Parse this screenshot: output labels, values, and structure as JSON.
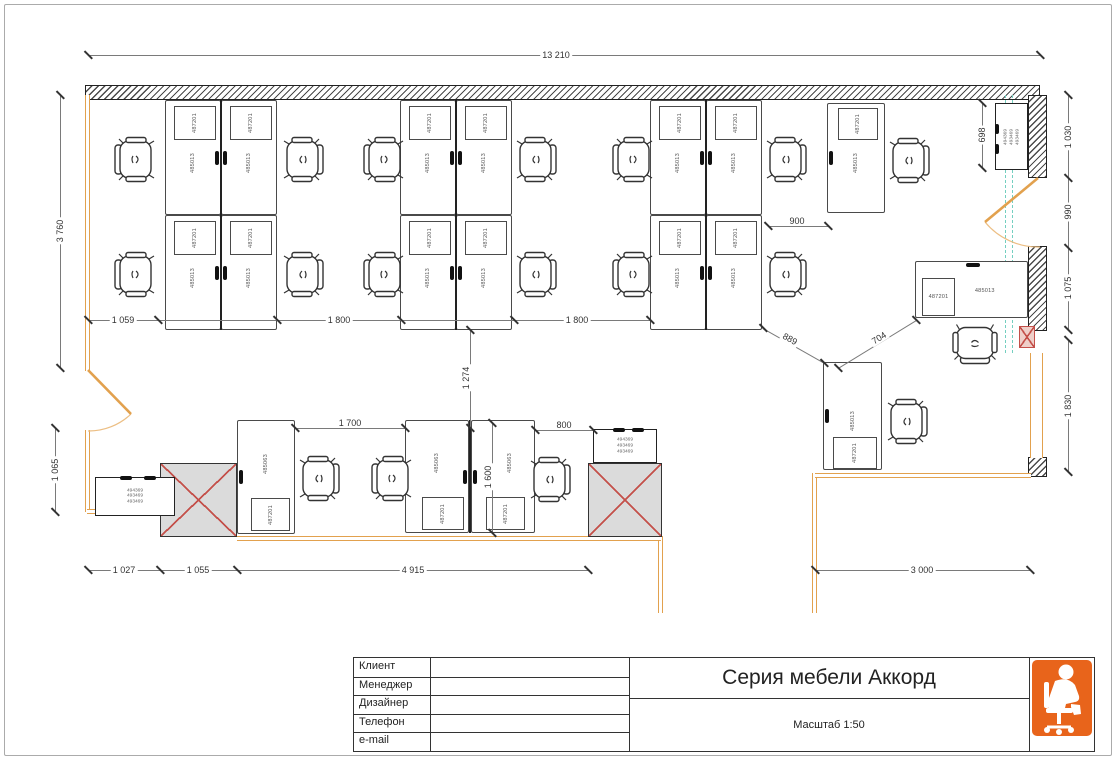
{
  "title_block": {
    "fields": [
      {
        "key": "client",
        "label": "Клиент"
      },
      {
        "key": "manager",
        "label": "Менеджер"
      },
      {
        "key": "designer",
        "label": "Дизайнер"
      },
      {
        "key": "phone",
        "label": "Телефон"
      },
      {
        "key": "email",
        "label": "e-mail"
      }
    ],
    "title": "Серия мебели Аккорд",
    "scale": "Масштаб 1:50"
  },
  "colors": {
    "wall_accent": "#E2A14E",
    "glass_dash": "#74CFC0",
    "column_cross": "#C4504A",
    "column_fill": "#DBDBDB",
    "logo_orange": "#E8641B",
    "dim_text": "#333333"
  },
  "plan": {
    "walls": [
      {
        "t": "hatch",
        "x": 85,
        "y": 85,
        "w": 955,
        "h": 15
      },
      {
        "t": "hatch",
        "x": 1028,
        "y": 95,
        "w": 19,
        "h": 83
      },
      {
        "t": "hatch",
        "x": 1028,
        "y": 246,
        "w": 19,
        "h": 85
      },
      {
        "t": "hatch",
        "x": 1028,
        "y": 457,
        "w": 19,
        "h": 20
      },
      {
        "t": "owv",
        "x": 85,
        "y": 95,
        "w": 5,
        "h": 276
      },
      {
        "t": "owv",
        "x": 85,
        "y": 430,
        "w": 5,
        "h": 82
      },
      {
        "t": "owv",
        "x": 658,
        "y": 536,
        "w": 5,
        "h": 77
      },
      {
        "t": "owv",
        "x": 812,
        "y": 473,
        "w": 5,
        "h": 140
      },
      {
        "t": "owv",
        "x": 1030,
        "y": 353,
        "w": 13,
        "h": 105
      },
      {
        "t": "owh",
        "x": 87,
        "y": 509,
        "w": 73,
        "h": 5
      },
      {
        "t": "owh",
        "x": 237,
        "y": 536,
        "w": 424,
        "h": 5
      },
      {
        "t": "owh",
        "x": 815,
        "y": 473,
        "w": 216,
        "h": 5
      }
    ],
    "glass_lines": [
      {
        "x": 1005,
        "y": 95,
        "h": 258
      },
      {
        "x": 1012,
        "y": 95,
        "h": 258
      }
    ],
    "doors": [
      {
        "type": "left",
        "x": 84,
        "y": 366
      },
      {
        "type": "right",
        "x": 980,
        "y": 174
      }
    ],
    "dividers": [
      {
        "x": 220,
        "y": 100,
        "len": 230
      },
      {
        "x": 455,
        "y": 100,
        "len": 230
      },
      {
        "x": 705,
        "y": 100,
        "len": 230
      },
      {
        "x": 469,
        "y": 420,
        "len": 113
      }
    ],
    "desks": [
      {
        "x": 165,
        "y": 100,
        "w": 56,
        "h": 115,
        "code": "485013",
        "box": [
          8,
          5,
          40,
          32
        ],
        "boxCode": "487201",
        "handle": "r"
      },
      {
        "x": 221,
        "y": 100,
        "w": 56,
        "h": 115,
        "code": "485013",
        "box": [
          8,
          5,
          40,
          32
        ],
        "boxCode": "487201",
        "handle": "l"
      },
      {
        "x": 165,
        "y": 215,
        "w": 56,
        "h": 115,
        "code": "485013",
        "box": [
          8,
          5,
          40,
          32
        ],
        "boxCode": "487201",
        "handle": "r"
      },
      {
        "x": 221,
        "y": 215,
        "w": 56,
        "h": 115,
        "code": "485013",
        "box": [
          8,
          5,
          40,
          32
        ],
        "boxCode": "487201",
        "handle": "l"
      },
      {
        "x": 400,
        "y": 100,
        "w": 56,
        "h": 115,
        "code": "485013",
        "box": [
          8,
          5,
          40,
          32
        ],
        "boxCode": "487201",
        "handle": "r"
      },
      {
        "x": 456,
        "y": 100,
        "w": 56,
        "h": 115,
        "code": "485013",
        "box": [
          8,
          5,
          40,
          32
        ],
        "boxCode": "487201",
        "handle": "l"
      },
      {
        "x": 400,
        "y": 215,
        "w": 56,
        "h": 115,
        "code": "485013",
        "box": [
          8,
          5,
          40,
          32
        ],
        "boxCode": "487201",
        "handle": "r"
      },
      {
        "x": 456,
        "y": 215,
        "w": 56,
        "h": 115,
        "code": "485013",
        "box": [
          8,
          5,
          40,
          32
        ],
        "boxCode": "487201",
        "handle": "l"
      },
      {
        "x": 650,
        "y": 100,
        "w": 56,
        "h": 115,
        "code": "485013",
        "box": [
          8,
          5,
          40,
          32
        ],
        "boxCode": "487201",
        "handle": "r"
      },
      {
        "x": 706,
        "y": 100,
        "w": 56,
        "h": 115,
        "code": "485013",
        "box": [
          8,
          5,
          40,
          32
        ],
        "boxCode": "487201",
        "handle": "l"
      },
      {
        "x": 650,
        "y": 215,
        "w": 56,
        "h": 115,
        "code": "485013",
        "box": [
          8,
          5,
          40,
          32
        ],
        "boxCode": "487201",
        "handle": "r"
      },
      {
        "x": 706,
        "y": 215,
        "w": 56,
        "h": 115,
        "code": "485013",
        "box": [
          8,
          5,
          40,
          32
        ],
        "boxCode": "487201",
        "handle": "l"
      },
      {
        "x": 827,
        "y": 103,
        "w": 58,
        "h": 110,
        "code": "485013",
        "box": [
          10,
          4,
          38,
          30
        ],
        "boxCode": "487201",
        "handle": "l"
      },
      {
        "x": 915,
        "y": 261,
        "w": 113,
        "h": 57,
        "code": "485013",
        "crot": 0,
        "cpos": [
          0.62,
          0.52
        ],
        "box": [
          6,
          16,
          31,
          36
        ],
        "boxCode": "487201",
        "brot": 0,
        "handle": "t"
      },
      {
        "x": 823,
        "y": 362,
        "w": 59,
        "h": 108,
        "code": "485013",
        "box": [
          9,
          74,
          42,
          30
        ],
        "boxCode": "487201",
        "handle": "l"
      },
      {
        "x": 237,
        "y": 420,
        "w": 58,
        "h": 114,
        "code": "485063",
        "cpos": [
          0.5,
          0.38
        ],
        "box": [
          13,
          77,
          37,
          31
        ],
        "boxCode": "487201",
        "handle": "l"
      },
      {
        "x": 405,
        "y": 420,
        "w": 64,
        "h": 113,
        "code": "485063",
        "cpos": [
          0.5,
          0.38
        ],
        "box": [
          16,
          76,
          40,
          31
        ],
        "boxCode": "487201",
        "handle": "r"
      },
      {
        "x": 471,
        "y": 420,
        "w": 64,
        "h": 113,
        "code": "485063",
        "cpos": [
          0.62,
          0.38
        ],
        "box": [
          14,
          76,
          37,
          31
        ],
        "boxCode": "487201",
        "handle": "l"
      }
    ],
    "cabinets": [
      {
        "x": 95,
        "y": 477,
        "w": 80,
        "h": 39,
        "codes": [
          "494369",
          "493469",
          "493469"
        ],
        "vertical": false
      },
      {
        "x": 593,
        "y": 429,
        "w": 64,
        "h": 34,
        "codes": [
          "494369",
          "493469",
          "493469"
        ],
        "vertical": false
      },
      {
        "x": 995,
        "y": 103,
        "w": 33,
        "h": 67,
        "codes": [
          "494369",
          "493469",
          "493469"
        ],
        "vertical": true
      }
    ],
    "columns": [
      {
        "x": 160,
        "y": 463,
        "w": 77,
        "h": 74
      },
      {
        "x": 588,
        "y": 463,
        "w": 74,
        "h": 74
      }
    ],
    "red_boxes": [
      {
        "x": 1019,
        "y": 326,
        "w": 16,
        "h": 22
      }
    ],
    "chairs": [
      {
        "x": 113,
        "y": 136,
        "r": 0
      },
      {
        "x": 281,
        "y": 136,
        "r": 180
      },
      {
        "x": 362,
        "y": 136,
        "r": 0
      },
      {
        "x": 514,
        "y": 136,
        "r": 180
      },
      {
        "x": 611,
        "y": 136,
        "r": 0
      },
      {
        "x": 764,
        "y": 136,
        "r": 180
      },
      {
        "x": 113,
        "y": 251,
        "r": 0
      },
      {
        "x": 281,
        "y": 251,
        "r": 180
      },
      {
        "x": 362,
        "y": 251,
        "r": 0
      },
      {
        "x": 514,
        "y": 251,
        "r": 180
      },
      {
        "x": 611,
        "y": 251,
        "r": 0
      },
      {
        "x": 764,
        "y": 251,
        "r": 180
      },
      {
        "x": 887,
        "y": 137,
        "r": 180
      },
      {
        "x": 953,
        "y": 320,
        "r": -90
      },
      {
        "x": 885,
        "y": 398,
        "r": 180
      },
      {
        "x": 297,
        "y": 455,
        "r": 180
      },
      {
        "x": 370,
        "y": 455,
        "r": 0
      },
      {
        "x": 528,
        "y": 456,
        "r": 180
      }
    ],
    "dim_lines": [
      {
        "x": 88,
        "y": 55,
        "len": 952,
        "o": "h",
        "ticks": [
          0,
          952
        ]
      },
      {
        "x": 88,
        "y": 320,
        "len": 562,
        "o": "h",
        "ticks": [
          0,
          70,
          189,
          313,
          426,
          562
        ]
      },
      {
        "x": 88,
        "y": 570,
        "len": 500,
        "o": "h",
        "ticks": [
          0,
          72,
          149,
          500
        ]
      },
      {
        "x": 815,
        "y": 570,
        "len": 215,
        "o": "h",
        "ticks": [
          0,
          215
        ]
      },
      {
        "x": 60,
        "y": 95,
        "len": 273,
        "o": "v",
        "ticks": [
          0,
          273
        ]
      },
      {
        "x": 55,
        "y": 428,
        "len": 84,
        "o": "v",
        "ticks": [
          0,
          84
        ]
      },
      {
        "x": 1068,
        "y": 95,
        "len": 235,
        "o": "v",
        "ticks": [
          0,
          83,
          153,
          235
        ]
      },
      {
        "x": 1068,
        "y": 340,
        "len": 132,
        "o": "v",
        "ticks": [
          0,
          132
        ]
      },
      {
        "x": 982,
        "y": 103,
        "len": 65,
        "o": "v",
        "ticks": [
          0,
          65
        ]
      },
      {
        "x": 768,
        "y": 226,
        "len": 60,
        "o": "h",
        "ticks": [
          0,
          60
        ]
      },
      {
        "x": 295,
        "y": 428,
        "len": 110,
        "o": "h",
        "ticks": [
          0,
          110
        ]
      },
      {
        "x": 535,
        "y": 430,
        "len": 58,
        "o": "h",
        "ticks": [
          0,
          58
        ]
      },
      {
        "x": 492,
        "y": 423,
        "len": 110,
        "o": "v",
        "ticks": [
          0,
          110
        ]
      },
      {
        "x": 470,
        "y": 330,
        "len": 98,
        "o": "v",
        "ticks": [
          0,
          98
        ]
      },
      {
        "x": 763,
        "y": 328,
        "len": 71,
        "o": "d",
        "a": 29.5,
        "ticks": [
          0,
          71
        ]
      },
      {
        "x": 838,
        "y": 368,
        "len": 92,
        "o": "d",
        "a": -31.5,
        "ticks": [
          0,
          92
        ]
      }
    ],
    "dim_labels": [
      {
        "text": "13 210",
        "x": 556,
        "y": 55,
        "r": 0
      },
      {
        "text": "1 059",
        "x": 123,
        "y": 320,
        "r": 0
      },
      {
        "text": "1 800",
        "x": 339,
        "y": 320,
        "r": 0
      },
      {
        "text": "1 800",
        "x": 577,
        "y": 320,
        "r": 0
      },
      {
        "text": "1 027",
        "x": 124,
        "y": 570,
        "r": 0
      },
      {
        "text": "1 055",
        "x": 198,
        "y": 570,
        "r": 0
      },
      {
        "text": "4 915",
        "x": 413,
        "y": 570,
        "r": 0
      },
      {
        "text": "3 000",
        "x": 922,
        "y": 570,
        "r": 0
      },
      {
        "text": "3 760",
        "x": 60,
        "y": 231,
        "r": -90
      },
      {
        "text": "1 065",
        "x": 55,
        "y": 470,
        "r": -90
      },
      {
        "text": "1 030",
        "x": 1068,
        "y": 137,
        "r": -90
      },
      {
        "text": "990",
        "x": 1068,
        "y": 212,
        "r": -90
      },
      {
        "text": "1 075",
        "x": 1068,
        "y": 288,
        "r": -90
      },
      {
        "text": "1 830",
        "x": 1068,
        "y": 406,
        "r": -90
      },
      {
        "text": "698",
        "x": 982,
        "y": 135,
        "r": -90
      },
      {
        "text": "900",
        "x": 797,
        "y": 221,
        "r": 0
      },
      {
        "text": "1 700",
        "x": 350,
        "y": 423,
        "r": 0
      },
      {
        "text": "800",
        "x": 564,
        "y": 425,
        "r": 0
      },
      {
        "text": "1 600",
        "x": 488,
        "y": 477,
        "r": -90
      },
      {
        "text": "1 274",
        "x": 466,
        "y": 378,
        "r": -90
      },
      {
        "text": "889",
        "x": 790,
        "y": 339,
        "r": 29
      },
      {
        "text": "704",
        "x": 879,
        "y": 338,
        "r": -32
      }
    ]
  }
}
